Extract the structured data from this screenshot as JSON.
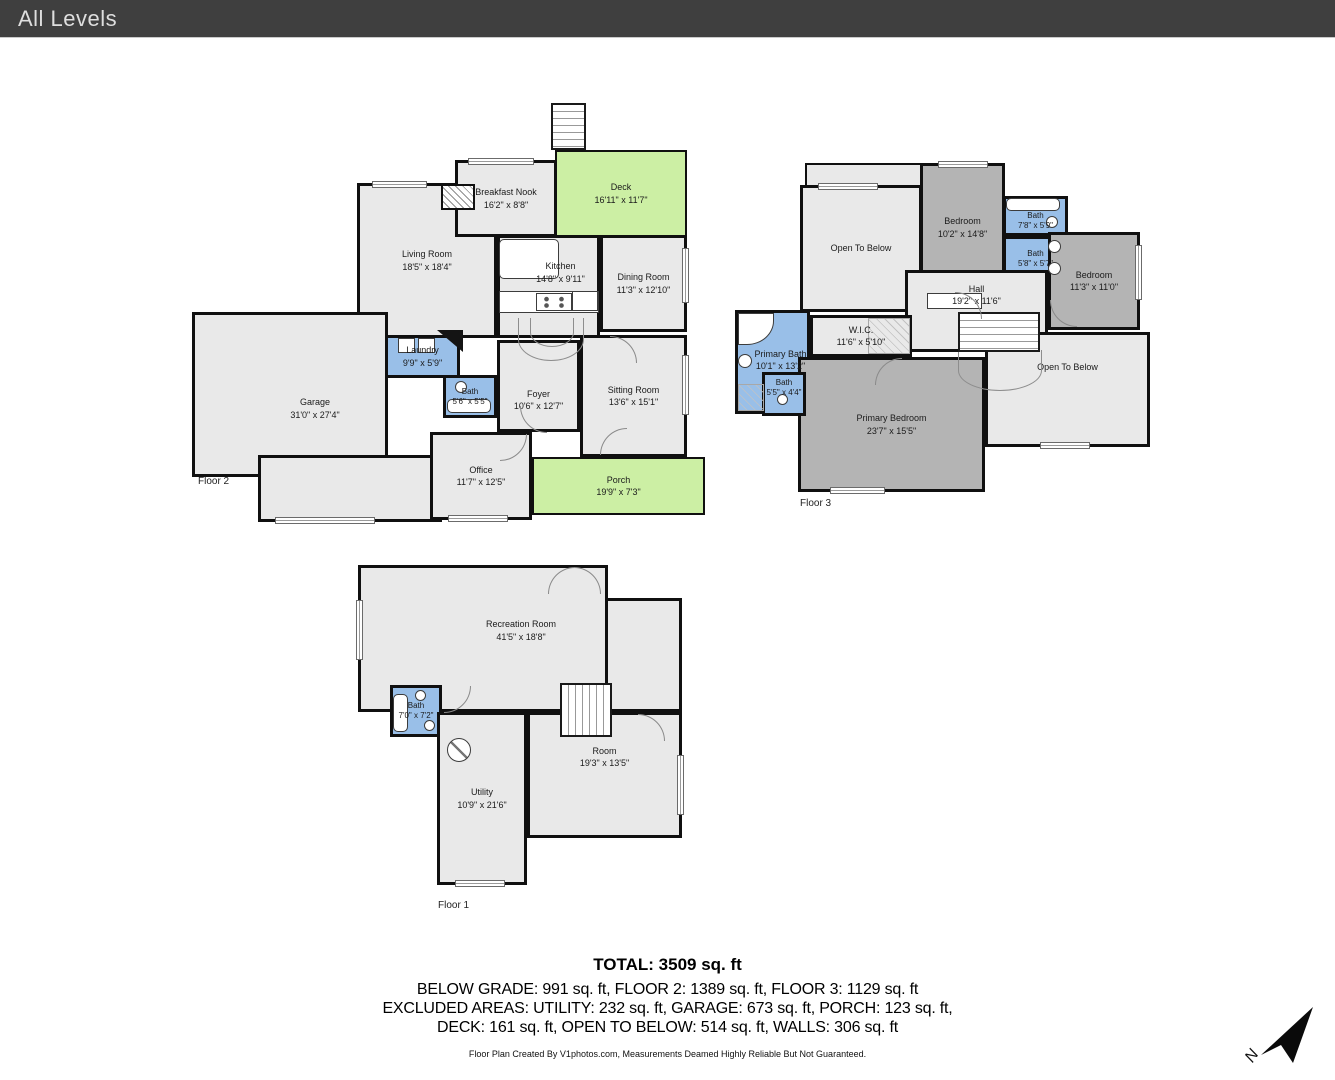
{
  "header": {
    "title": "All Levels"
  },
  "colors": {
    "header_bg": "#3f3f3f",
    "room_gray": "#e9e9e9",
    "bedroom_gray": "#b4b4b4",
    "bath_blue": "#99bfe8",
    "outdoor_green": "#ccefa4",
    "wall": "#101010"
  },
  "floors": {
    "floor2": {
      "caption": "Floor 2",
      "rooms": {
        "living": {
          "name": "Living Room",
          "dims": "18'5\" x 18'4\""
        },
        "breakfast": {
          "name": "Breakfast Nook",
          "dims": "16'2\" x 8'8\""
        },
        "deck": {
          "name": "Deck",
          "dims": "16'11\" x 11'7\""
        },
        "kitchen": {
          "name": "Kitchen",
          "dims": "14'8\" x 9'11\""
        },
        "dining": {
          "name": "Dining Room",
          "dims": "11'3\" x 12'10\""
        },
        "laundry": {
          "name": "Laundry",
          "dims": "9'9\" x 5'9\""
        },
        "bath": {
          "name": "Bath",
          "dims": "5'6\" x 5'5\""
        },
        "garage": {
          "name": "Garage",
          "dims": "31'0\" x 27'4\""
        },
        "foyer": {
          "name": "Foyer",
          "dims": "10'6\" x 12'7\""
        },
        "sitting": {
          "name": "Sitting Room",
          "dims": "13'6\" x 15'1\""
        },
        "office": {
          "name": "Office",
          "dims": "11'7\" x 12'5\""
        },
        "porch": {
          "name": "Porch",
          "dims": "19'9\" x 7'3\""
        }
      }
    },
    "floor3": {
      "caption": "Floor 3",
      "rooms": {
        "otbLeft": {
          "name": "Open To Below",
          "dims": ""
        },
        "bedroom1": {
          "name": "Bedroom",
          "dims": "10'2\" x 14'8\""
        },
        "bath1": {
          "name": "Bath",
          "dims": "7'8\" x 5'9\""
        },
        "bath2": {
          "name": "Bath",
          "dims": "5'8\" x 5'7\""
        },
        "bedroom2": {
          "name": "Bedroom",
          "dims": "11'3\" x 11'0\""
        },
        "hall": {
          "name": "Hall",
          "dims": "19'2\" x 11'6\""
        },
        "wic": {
          "name": "W.I.C.",
          "dims": "11'6\" x 5'10\""
        },
        "primaryBath": {
          "name": "Primary Bath",
          "dims": "10'1\" x 13'2\""
        },
        "smallBath": {
          "name": "Bath",
          "dims": "5'5\" x 4'4\""
        },
        "primaryBedroom": {
          "name": "Primary Bedroom",
          "dims": "23'7\" x 15'5\""
        },
        "otbRight": {
          "name": "Open To Below",
          "dims": ""
        }
      }
    },
    "floor1": {
      "caption": "Floor 1",
      "rooms": {
        "rec": {
          "name": "Recreation Room",
          "dims": "41'5\" x 18'8\""
        },
        "bath": {
          "name": "Bath",
          "dims": "7'0\" x 7'2\""
        },
        "room": {
          "name": "Room",
          "dims": "19'3\" x 13'5\""
        },
        "utility": {
          "name": "Utility",
          "dims": "10'9\" x 21'6\""
        }
      }
    }
  },
  "summary": {
    "total": "TOTAL: 3509 sq. ft",
    "line1": "BELOW GRADE: 991 sq. ft, FLOOR 2: 1389 sq. ft, FLOOR 3: 1129 sq. ft",
    "line2": "EXCLUDED AREAS: UTILITY: 232 sq. ft, GARAGE: 673 sq. ft, PORCH: 123 sq. ft,",
    "line3": "DECK: 161 sq. ft, OPEN TO BELOW: 514 sq. ft, WALLS: 306 sq. ft",
    "disclaimer": "Floor Plan Created By V1photos.com, Measurements Deamed Highly Reliable But Not Guaranteed."
  },
  "compass": {
    "label": "N"
  }
}
